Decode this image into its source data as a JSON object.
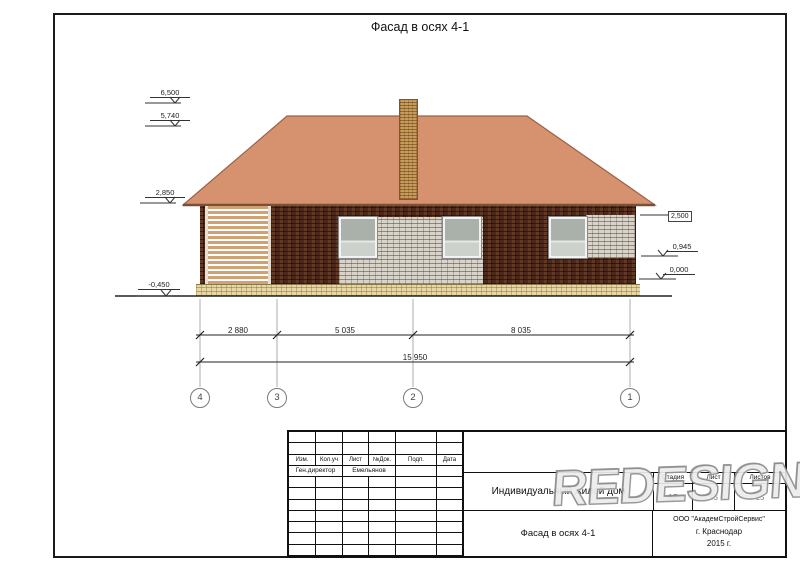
{
  "sheet": {
    "title": "Фасад в осях 4-1"
  },
  "levels": {
    "l1": "6,500",
    "l2": "5,740",
    "l3": "2,850",
    "l4": "-0,450",
    "r1": "2,500",
    "r2": "0,945",
    "r3": "0,000"
  },
  "dims": {
    "d1": "2 880",
    "d2": "5 035",
    "d3": "8 035",
    "total": "15 950"
  },
  "axes": {
    "a4": "4",
    "a3": "3",
    "a2": "2",
    "a1": "1"
  },
  "title_block": {
    "cols": {
      "izm": "Изм.",
      "koluch": "Кол.уч",
      "list": "Лист",
      "ndok": "№Док.",
      "podp": "Подп.",
      "data": "Дата"
    },
    "row_role": "Ген.директор",
    "row_name": "Емельянов",
    "object_name": "Индивидуальный жилой дом",
    "stage_label": "Стадия",
    "sheet_label": "Лист",
    "sheets_label": "Листов",
    "stage_value": "АР",
    "sheet_value": "13",
    "sheets_value": "15",
    "drawing_name": "Фасад в осях 4-1",
    "org": "ООО \"АкадемСтройСервис\"",
    "city": "г. Краснодар",
    "year": "2015 г."
  },
  "watermark": "REDESIGN",
  "colors": {
    "roof": "#d6926f",
    "wall_brick": "#4b2a1d",
    "light_brick": "#d9d4ca",
    "slats": "#d0a172",
    "plinth": "#e7d7a5",
    "chimney": "#c89d5c"
  }
}
